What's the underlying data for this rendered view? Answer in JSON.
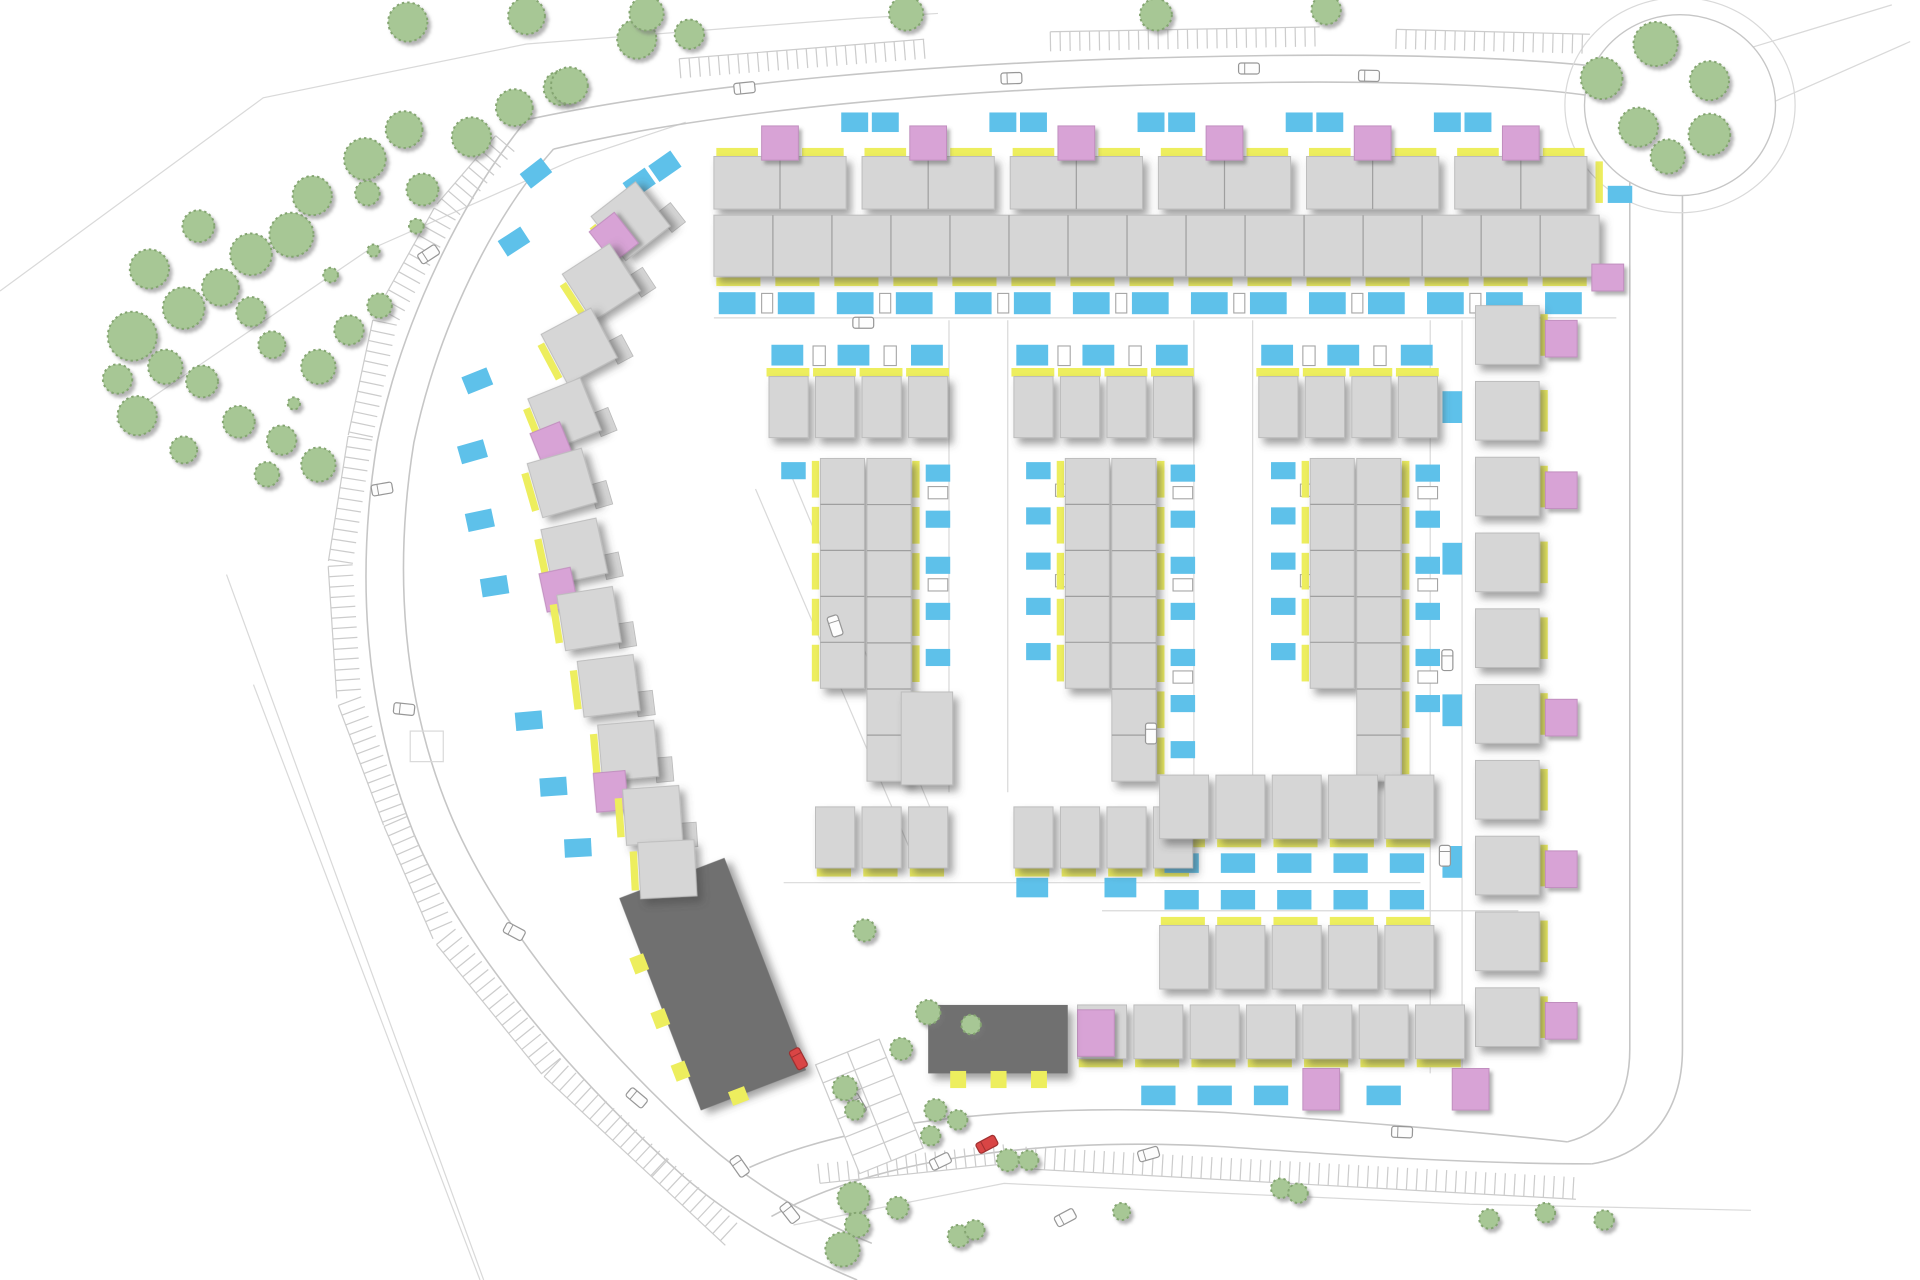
{
  "canvas": {
    "viewbox_w": 1568,
    "viewbox_h": 1047,
    "out_w": 1920,
    "out_h": 1280
  },
  "colors": {
    "bg": "#ffffff",
    "house": "#d6d6d6",
    "house_stroke": "#bcbcbc",
    "divider": "#9f9f9f",
    "dark_block": "#6f6f6f",
    "pink": "#d8a3d6",
    "pink_stroke": "#c08ebe",
    "yellow": "#edee5e",
    "blue": "#5ec1ea",
    "tree_fill": "#a7c795",
    "tree_stroke": "#84a571",
    "road_line": "#c6c6c6",
    "faint_line": "#d9d9d9",
    "comb": "#cccccc",
    "shed_stroke": "#a5a5a5",
    "car_fill": "#fdfdfd",
    "car_stroke": "#979797",
    "red_car": "#d94545"
  },
  "boundaries": [
    [
      [
        0,
        238
      ],
      [
        215,
        80
      ],
      [
        430,
        36
      ],
      [
        700,
        15
      ],
      [
        766,
        11
      ]
    ],
    [
      [
        95,
        345
      ],
      [
        300,
        205
      ],
      [
        470,
        130
      ],
      [
        560,
        100
      ]
    ],
    [
      [
        185,
        470
      ],
      [
        395,
        1047
      ]
    ],
    [
      [
        207,
        560
      ],
      [
        392,
        1047
      ]
    ],
    [
      [
        648,
        1002
      ],
      [
        820,
        968
      ],
      [
        1200,
        985
      ],
      [
        1430,
        990
      ]
    ],
    [
      [
        1420,
        42
      ],
      [
        1545,
        4
      ]
    ],
    [
      [
        1447,
        84
      ],
      [
        1560,
        34
      ]
    ]
  ],
  "roads": [
    "M430,98 C560,70 760,50 1000,46 C1150,43 1290,48 1355,62",
    "M452,122 C575,92 770,72 1000,68 C1140,65 1270,70 1330,84",
    "M430,98 C378,162 328,262 308,362 C290,472 298,582 338,682 C378,777 468,882 558,962 C598,997 650,1026 700,1047",
    "M452,122 C403,177 358,267 338,362 C321,467 329,572 367,664 C404,754 487,854 571,930 C612,967 660,996 712,1017",
    "M1355,62 C1340,80 1332,105 1331,140 L1331,858 C1331,900 1312,926 1280,934",
    "M1374,158 L1374,858 C1374,912 1344,945 1300,952",
    "M612,955 C700,915 840,902 1000,910 C1100,917 1200,925 1280,934",
    "M630,995 C720,945 860,930 1000,938 C1100,945 1200,952 1300,952"
  ],
  "oval_green": {
    "cx": 1372,
    "cy": 86,
    "rx": 78,
    "ry": 74,
    "outer_rx": 94,
    "outer_ry": 88
  },
  "layby": [
    335,
    598,
    27,
    25
  ],
  "street_lines": [
    [
      583,
      260,
      1320,
      260
    ],
    [
      775,
      262,
      775,
      648
    ],
    [
      823,
      262,
      823,
      648
    ],
    [
      975,
      262,
      975,
      648
    ],
    [
      1023,
      262,
      1023,
      648
    ],
    [
      1168,
      262,
      1168,
      878
    ],
    [
      1194,
      262,
      1194,
      878
    ],
    [
      640,
      722,
      1160,
      722
    ],
    [
      900,
      745,
      1240,
      745
    ],
    [
      617,
      400,
      742,
      692
    ],
    [
      645,
      386,
      766,
      676
    ]
  ],
  "combs": [
    {
      "pts": [
        [
          420,
          124
        ],
        [
          372,
          180
        ],
        [
          324,
          266
        ],
        [
          304,
          360
        ],
        [
          288,
          462
        ],
        [
          295,
          570
        ],
        [
          332,
          668
        ],
        [
          372,
          760
        ],
        [
          458,
          866
        ],
        [
          546,
          948
        ],
        [
          606,
          1004
        ]
      ],
      "len": 20,
      "spacing": 8.5,
      "side": 1
    },
    {
      "pts": [
        [
          556,
          64
        ],
        [
          756,
          48
        ]
      ],
      "len": 16,
      "spacing": 8,
      "side": -1
    },
    {
      "pts": [
        [
          858,
          42
        ],
        [
          1078,
          38
        ]
      ],
      "len": 16,
      "spacing": 8,
      "side": -1
    },
    {
      "pts": [
        [
          1140,
          40
        ],
        [
          1298,
          44
        ]
      ],
      "len": 16,
      "spacing": 8,
      "side": -1
    },
    {
      "pts": [
        [
          838,
          938
        ],
        [
          1288,
          963
        ]
      ],
      "len": 18,
      "spacing": 8,
      "side": 1
    },
    {
      "pts": [
        [
          668,
          952
        ],
        [
          820,
          936
        ]
      ],
      "len": 16,
      "spacing": 8,
      "side": 1
    }
  ],
  "parking_fan": {
    "x": 710,
    "y": 905,
    "rot": -22,
    "w": 56,
    "h": 96,
    "rows": 6
  },
  "trees_band": [
    [
      108,
      275,
      20
    ],
    [
      150,
      252,
      17
    ],
    [
      122,
      220,
      16
    ],
    [
      180,
      235,
      15
    ],
    [
      205,
      208,
      17
    ],
    [
      238,
      192,
      18
    ],
    [
      162,
      185,
      13
    ],
    [
      255,
      160,
      16
    ],
    [
      298,
      130,
      17
    ],
    [
      330,
      106,
      15
    ],
    [
      345,
      155,
      13
    ],
    [
      385,
      112,
      16
    ],
    [
      420,
      88,
      15
    ],
    [
      458,
      72,
      14
    ],
    [
      520,
      32,
      16
    ],
    [
      300,
      158,
      10
    ],
    [
      135,
      300,
      14
    ],
    [
      112,
      340,
      16
    ],
    [
      165,
      312,
      13
    ],
    [
      205,
      255,
      12
    ],
    [
      222,
      282,
      11
    ],
    [
      260,
      300,
      14
    ],
    [
      285,
      270,
      12
    ],
    [
      310,
      250,
      10
    ],
    [
      195,
      345,
      13
    ],
    [
      230,
      360,
      12
    ],
    [
      260,
      380,
      14
    ],
    [
      218,
      388,
      10
    ],
    [
      150,
      368,
      11
    ],
    [
      96,
      310,
      12
    ],
    [
      340,
      185,
      6
    ],
    [
      270,
      225,
      6
    ],
    [
      240,
      330,
      5
    ],
    [
      305,
      205,
      5
    ]
  ],
  "trees_top": [
    [
      333,
      18,
      16
    ],
    [
      430,
      13,
      15
    ],
    [
      528,
      11,
      14
    ],
    [
      740,
      11,
      14
    ],
    [
      944,
      12,
      13
    ],
    [
      1083,
      8,
      12
    ],
    [
      465,
      70,
      15
    ],
    [
      563,
      28,
      12
    ]
  ],
  "trees_oval": [
    [
      1352,
      36,
      18
    ],
    [
      1308,
      64,
      17
    ],
    [
      1396,
      66,
      16
    ],
    [
      1338,
      104,
      16
    ],
    [
      1396,
      110,
      17
    ],
    [
      1362,
      128,
      14
    ]
  ],
  "trees_bottom": [
    [
      706,
      761,
      9
    ],
    [
      758,
      828,
      10
    ],
    [
      736,
      858,
      9
    ],
    [
      793,
      838,
      8
    ],
    [
      690,
      890,
      10
    ],
    [
      698,
      908,
      8
    ],
    [
      764,
      908,
      9
    ],
    [
      782,
      916,
      8
    ],
    [
      760,
      929,
      8
    ],
    [
      823,
      949,
      9
    ],
    [
      840,
      949,
      8
    ],
    [
      697,
      980,
      13
    ],
    [
      733,
      988,
      9
    ],
    [
      700,
      1002,
      10
    ],
    [
      688,
      1022,
      14
    ],
    [
      783,
      1011,
      9
    ],
    [
      796,
      1006,
      8
    ],
    [
      916,
      991,
      7
    ],
    [
      1046,
      972,
      8
    ],
    [
      1060,
      976,
      8
    ],
    [
      1216,
      997,
      8
    ],
    [
      1262,
      992,
      8
    ],
    [
      1310,
      998,
      8
    ]
  ],
  "top_terrace": {
    "rowA": {
      "x0": 583,
      "pitch": 121,
      "count": 6,
      "w": 108,
      "h": 43,
      "y": 128
    },
    "rowA_pink": {
      "dx": 39,
      "y": 103,
      "w": 30,
      "h": 28
    },
    "rowA_yellow_dx": [
      2,
      72
    ],
    "rowA_yellow": {
      "y": 121,
      "w": 34,
      "h": 7
    },
    "gap_blues": {
      "dxs": [
        104,
        129
      ],
      "y": 92,
      "w": 22,
      "h": 16,
      "last_k": 4
    },
    "lead_blues": [
      [
        543,
        136,
        -35
      ],
      [
        522,
        150,
        -35
      ]
    ],
    "rowB": {
      "x": 583,
      "y": 176,
      "w": 723,
      "h": 50,
      "units": 15
    },
    "rowB_yellow": {
      "x0": 585,
      "pitch": 48.2,
      "count": 15,
      "y": 227,
      "w": 36,
      "h": 7
    },
    "band_blues": {
      "x0": 587,
      "pitch": 48.2,
      "count": 15,
      "y": 239,
      "w": 30,
      "h": 18
    },
    "band_shed_ks": [
      0,
      2,
      4,
      6,
      8,
      10,
      12
    ],
    "end_cap": {
      "yellow": [
        1303,
        132,
        6,
        34
      ],
      "blue": [
        1313,
        152,
        20,
        14
      ],
      "pink": [
        1300,
        216,
        26,
        22
      ]
    }
  },
  "cluster_template": {
    "pre_blue_dx": [
      -70,
      -16,
      44
    ],
    "pre_blue": {
      "y": 282,
      "w": 26,
      "h": 17
    },
    "pre_shed_dx": [
      -36,
      22
    ],
    "pre_shed": {
      "y": 283,
      "w": 10,
      "h": 16
    },
    "top_house_dx": [
      -72,
      -34,
      4,
      42
    ],
    "top_house": {
      "y": 308,
      "w": 32,
      "h": 50
    },
    "top_yellow_dx": [
      -74,
      -36,
      2,
      40
    ],
    "top_yellow": {
      "y": 301,
      "w": 35,
      "h": 7
    },
    "left_col": {
      "dx": -62,
      "y0": 378,
      "pitch": 37,
      "w": 20,
      "h": 14,
      "shed_dx": -38,
      "shed_y0": 396,
      "shed_pitch": 74,
      "shed_w": 15,
      "shed_h": 10
    },
    "left_finger": {
      "dx": -30,
      "y": 375,
      "w": 36,
      "len": 188,
      "segs": 5,
      "yellow_dx": -37
    },
    "right_finger": {
      "dx": 8,
      "y": 375,
      "w": 36,
      "len": 264,
      "segs": 7,
      "yellow_dx": 45
    },
    "right_col": {
      "dx": 56,
      "y0": 380,
      "pitch": 37.7,
      "w": 20,
      "h": 14,
      "shed_dx": 58,
      "shed_w": 16,
      "shed_h": 10
    }
  },
  "clusters": [
    {
      "cx": 700,
      "left_blue_ks": [
        0
      ],
      "left_shed_ks": [],
      "right_blue_ks": [
        0,
        1,
        2,
        3,
        4
      ],
      "right_shed_ks": [
        0,
        1
      ],
      "offset_block": {
        "x": 736,
        "y": 566,
        "w": 42,
        "h": 76,
        "yellows": [
          [
            730,
            572,
            6,
            26
          ],
          [
            730,
            610,
            6,
            26
          ]
        ]
      }
    },
    {
      "cx": 900,
      "left_blue_ks": [
        0,
        1,
        2,
        3,
        4
      ],
      "left_shed_ks": [
        0,
        1
      ],
      "right_blue_ks": [
        0,
        1,
        2,
        3,
        4,
        5,
        6
      ],
      "right_shed_ks": [
        0,
        1,
        2
      ]
    },
    {
      "cx": 1100,
      "left_blue_ks": [
        0,
        1,
        2,
        3,
        4
      ],
      "left_shed_ks": [
        0,
        1
      ],
      "right_blue_ks": [
        0,
        1,
        2,
        3,
        4,
        5
      ],
      "right_shed_ks": [
        0,
        1,
        2
      ]
    }
  ],
  "right_column": {
    "x": 1205,
    "y0": 250,
    "pitch": 62,
    "count": 10,
    "w": 52,
    "h": 48,
    "yellow": {
      "dx": 53,
      "dy": 7,
      "w": 6,
      "h": 34
    },
    "pink_ks": [
      0,
      2,
      5,
      7,
      9
    ],
    "pink": {
      "dx": 57,
      "dy": 12,
      "w": 26,
      "h": 30
    },
    "street_blues": {
      "x": 1178,
      "ys": [
        320,
        444,
        568,
        692
      ],
      "w": 16,
      "h": 26
    }
  },
  "bottom_rows": [
    {
      "x0": 666,
      "pitch": 38,
      "count": 3,
      "y": 660,
      "w": 32,
      "h": 50,
      "yellow": "below"
    },
    {
      "x0": 828,
      "pitch": 38,
      "count": 4,
      "y": 660,
      "w": 32,
      "h": 50,
      "yellow": "below",
      "blues": [
        [
          830,
          718,
          26,
          16
        ],
        [
          902,
          718,
          26,
          16
        ]
      ]
    },
    {
      "x0": 947,
      "pitch": 46,
      "count": 5,
      "y": 634,
      "w": 40,
      "h": 52,
      "yellow": "below",
      "blue_row_y": 698
    },
    {
      "x0": 947,
      "pitch": 46,
      "count": 5,
      "y": 757,
      "w": 40,
      "h": 52,
      "yellow": "above",
      "blue_row_y": 728
    },
    {
      "x0": 880,
      "pitch": 46,
      "count": 7,
      "y": 822,
      "w": 40,
      "h": 44,
      "yellow": "below",
      "blues_ks": [
        1,
        2,
        3,
        5
      ],
      "blue_y": 888,
      "pinks": [
        [
          1064,
          874,
          30,
          34
        ],
        [
          1186,
          874,
          30,
          34
        ]
      ],
      "pink_house": [
        880,
        826,
        30,
        38
      ]
    }
  ],
  "dark_blocks": [
    {
      "cx": 582,
      "cy": 805,
      "w": 92,
      "h": 186,
      "rot": -21,
      "tabs": [
        [
          -56,
          -44,
          12,
          14
        ],
        [
          -56,
          4,
          12,
          14
        ],
        [
          -56,
          50,
          12,
          14
        ],
        [
          -20,
          87,
          14,
          12
        ]
      ]
    },
    {
      "cx": 815,
      "cy": 850,
      "w": 114,
      "h": 56,
      "rot": 0,
      "tabs": [
        [
          -39,
          26,
          13,
          14
        ],
        [
          -6,
          26,
          13,
          14
        ],
        [
          27,
          26,
          13,
          14
        ]
      ]
    }
  ],
  "arc_houses": [
    {
      "x": 492,
      "y": 158,
      "rot": -38,
      "pink": [
        -32,
        -14
      ]
    },
    {
      "x": 468,
      "y": 208,
      "rot": -33
    },
    {
      "x": 450,
      "y": 260,
      "rot": -28
    },
    {
      "x": 438,
      "y": 316,
      "rot": -22,
      "pink": [
        -32,
        4
      ]
    },
    {
      "x": 436,
      "y": 372,
      "rot": -16
    },
    {
      "x": 446,
      "y": 428,
      "rot": -12,
      "pink": [
        -32,
        12
      ]
    },
    {
      "x": 458,
      "y": 483,
      "rot": -9
    },
    {
      "x": 474,
      "y": 538,
      "rot": -7
    },
    {
      "x": 490,
      "y": 591,
      "rot": -5,
      "pink": [
        -30,
        16
      ]
    },
    {
      "x": 510,
      "y": 644,
      "rot": -4
    },
    {
      "x": 522,
      "y": 688,
      "rot": -3
    }
  ],
  "arc_blues": [
    [
      438,
      142,
      -38
    ],
    [
      420,
      198,
      -33
    ],
    [
      390,
      312,
      -22
    ],
    [
      386,
      370,
      -16
    ],
    [
      392,
      426,
      -12
    ],
    [
      404,
      480,
      -9
    ],
    [
      432,
      590,
      -5
    ],
    [
      452,
      644,
      -4
    ],
    [
      472,
      694,
      -3
    ]
  ],
  "cars": [
    [
      608,
      72,
      -6
    ],
    [
      826,
      64,
      -2
    ],
    [
      1020,
      56,
      0
    ],
    [
      1118,
      62,
      1
    ],
    [
      1305,
      70,
      8
    ],
    [
      350,
      208,
      -33
    ],
    [
      312,
      400,
      -10
    ],
    [
      330,
      580,
      6
    ],
    [
      420,
      762,
      28
    ],
    [
      520,
      898,
      40
    ],
    [
      705,
      264,
      0
    ],
    [
      682,
      512,
      72
    ],
    [
      940,
      600,
      90
    ],
    [
      1182,
      540,
      90
    ],
    [
      1180,
      700,
      90
    ],
    [
      700,
      903,
      60
    ],
    [
      768,
      950,
      -26
    ],
    [
      870,
      996,
      -28
    ],
    [
      938,
      944,
      -16
    ],
    [
      1145,
      926,
      2
    ],
    [
      604,
      954,
      55
    ],
    [
      645,
      992,
      52
    ]
  ],
  "red_cars": [
    [
      652,
      866,
      62
    ],
    [
      806,
      936,
      -28
    ]
  ]
}
